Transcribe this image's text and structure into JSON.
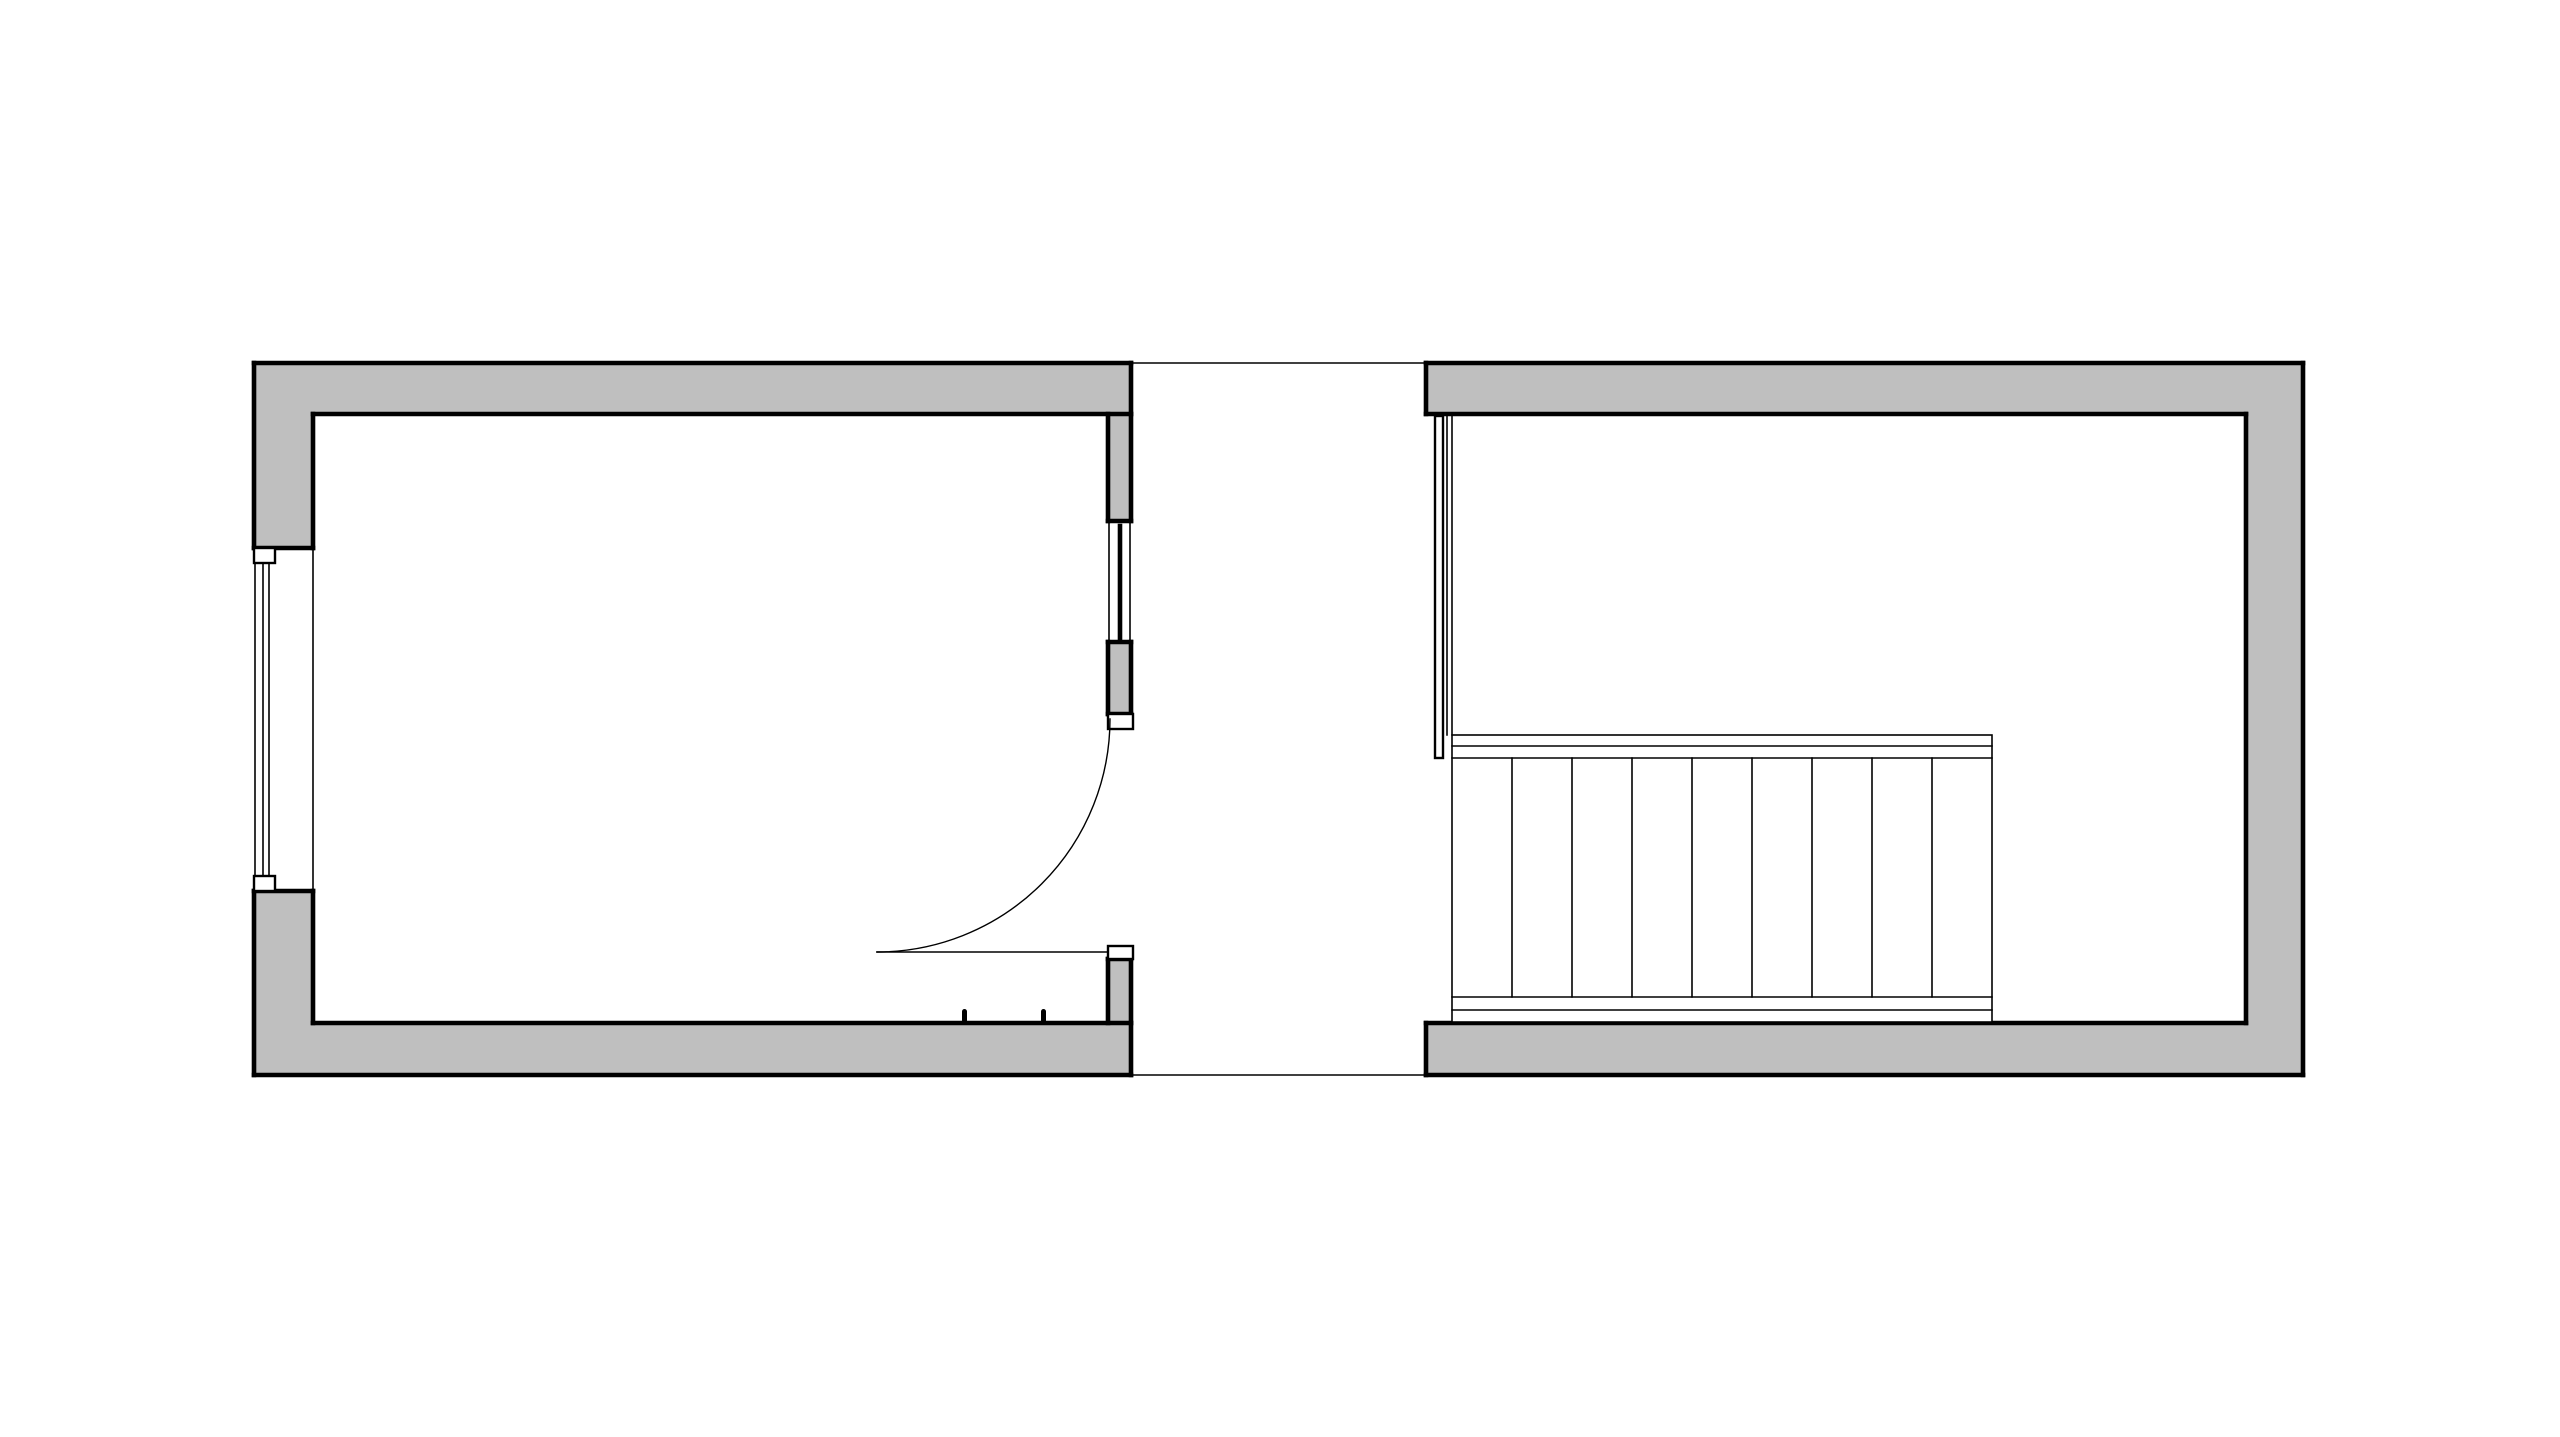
{
  "canvas": {
    "width": 2560,
    "height": 1437,
    "background": "#ffffff"
  },
  "palette": {
    "wall_fill": "#bfbfbf",
    "outline": "#000000",
    "white": "#ffffff",
    "none": "none"
  },
  "stroke_widths": {
    "thick": 4.6,
    "medium": 2.4,
    "thin": 1.6,
    "hairline": 1.4
  },
  "plan": {
    "description_elements": {
      "left_room": "room with exterior window, door to corridor, sidelight window",
      "corridor": "open gap between rooms bounded by thin floor lines",
      "right_room": "room containing straight staircase with railing"
    }
  },
  "shapes": [
    {
      "name": "left-room-top-wall-fill",
      "kind": "rect",
      "x": 254,
      "y": 363,
      "w": 877,
      "h": 51,
      "fill": "wall_fill"
    },
    {
      "name": "left-room-left-wall-upper-fill",
      "kind": "rect",
      "x": 254,
      "y": 363,
      "w": 59,
      "h": 185,
      "fill": "wall_fill"
    },
    {
      "name": "left-room-left-wall-lower-fill",
      "kind": "rect",
      "x": 254,
      "y": 891,
      "w": 59,
      "h": 184,
      "fill": "wall_fill"
    },
    {
      "name": "left-room-bottom-wall-fill",
      "kind": "rect",
      "x": 254,
      "y": 1023,
      "w": 877,
      "h": 52,
      "fill": "wall_fill"
    },
    {
      "name": "partition-wall-upper-fill",
      "kind": "rect",
      "x": 1108,
      "y": 414,
      "w": 23,
      "h": 107,
      "fill": "wall_fill"
    },
    {
      "name": "partition-wall-middle-fill",
      "kind": "rect",
      "x": 1108,
      "y": 642,
      "w": 23,
      "h": 72,
      "fill": "wall_fill"
    },
    {
      "name": "partition-wall-lower-fill",
      "kind": "rect",
      "x": 1108,
      "y": 959,
      "w": 23,
      "h": 64,
      "fill": "wall_fill"
    },
    {
      "name": "right-room-top-wall-fill",
      "kind": "rect",
      "x": 1426,
      "y": 363,
      "w": 877,
      "h": 51,
      "fill": "wall_fill"
    },
    {
      "name": "right-room-right-wall-fill",
      "kind": "rect",
      "x": 2246,
      "y": 363,
      "w": 57,
      "h": 712,
      "fill": "wall_fill"
    },
    {
      "name": "right-room-bottom-wall-fill",
      "kind": "rect",
      "x": 1426,
      "y": 1023,
      "w": 877,
      "h": 52,
      "fill": "wall_fill"
    },
    {
      "name": "left-room-outer-top-edge",
      "kind": "line",
      "x1": 254,
      "y1": 363,
      "x2": 1131,
      "y2": 363,
      "stroke": "outline",
      "sw": "thick"
    },
    {
      "name": "left-room-outer-left-upper-edge",
      "kind": "line",
      "x1": 254,
      "y1": 363,
      "x2": 254,
      "y2": 548,
      "stroke": "outline",
      "sw": "thick"
    },
    {
      "name": "left-room-outer-left-lower-edge",
      "kind": "line",
      "x1": 254,
      "y1": 891,
      "x2": 254,
      "y2": 1075,
      "stroke": "outline",
      "sw": "thick"
    },
    {
      "name": "left-room-outer-bottom-edge",
      "kind": "line",
      "x1": 254,
      "y1": 1075,
      "x2": 1131,
      "y2": 1075,
      "stroke": "outline",
      "sw": "thick"
    },
    {
      "name": "left-room-top-wall-right-edge",
      "kind": "line",
      "x1": 1131,
      "y1": 363,
      "x2": 1131,
      "y2": 414,
      "stroke": "outline",
      "sw": "thick"
    },
    {
      "name": "left-room-bottom-wall-right-edge",
      "kind": "line",
      "x1": 1131,
      "y1": 1023,
      "x2": 1131,
      "y2": 1075,
      "stroke": "outline",
      "sw": "thick"
    },
    {
      "name": "left-room-inner-top-edge",
      "kind": "line",
      "x1": 313,
      "y1": 414,
      "x2": 1131,
      "y2": 414,
      "stroke": "outline",
      "sw": "thick"
    },
    {
      "name": "left-room-inner-left-upper-edge",
      "kind": "line",
      "x1": 313,
      "y1": 414,
      "x2": 313,
      "y2": 548,
      "stroke": "outline",
      "sw": "thick"
    },
    {
      "name": "left-room-inner-left-lower-edge",
      "kind": "line",
      "x1": 313,
      "y1": 891,
      "x2": 313,
      "y2": 1023,
      "stroke": "outline",
      "sw": "thick"
    },
    {
      "name": "left-room-inner-bottom-edge",
      "kind": "line",
      "x1": 313,
      "y1": 1023,
      "x2": 1131,
      "y2": 1023,
      "stroke": "outline",
      "sw": "thick"
    },
    {
      "name": "window-opening-top-edge",
      "kind": "line",
      "x1": 254,
      "y1": 548,
      "x2": 313,
      "y2": 548,
      "stroke": "outline",
      "sw": "thick"
    },
    {
      "name": "window-opening-bottom-edge",
      "kind": "line",
      "x1": 254,
      "y1": 891,
      "x2": 313,
      "y2": 891,
      "stroke": "outline",
      "sw": "thick"
    },
    {
      "name": "partition-upper-left-edge",
      "kind": "line",
      "x1": 1108,
      "y1": 414,
      "x2": 1108,
      "y2": 521,
      "stroke": "outline",
      "sw": "thick"
    },
    {
      "name": "partition-upper-right-edge",
      "kind": "line",
      "x1": 1131,
      "y1": 414,
      "x2": 1131,
      "y2": 521,
      "stroke": "outline",
      "sw": "thick"
    },
    {
      "name": "partition-upper-bottom-edge",
      "kind": "line",
      "x1": 1108,
      "y1": 521,
      "x2": 1131,
      "y2": 521,
      "stroke": "outline",
      "sw": "thick"
    },
    {
      "name": "partition-middle-top-edge",
      "kind": "line",
      "x1": 1108,
      "y1": 642,
      "x2": 1131,
      "y2": 642,
      "stroke": "outline",
      "sw": "thick"
    },
    {
      "name": "partition-middle-left-edge",
      "kind": "line",
      "x1": 1108,
      "y1": 642,
      "x2": 1108,
      "y2": 714,
      "stroke": "outline",
      "sw": "thick"
    },
    {
      "name": "partition-middle-right-edge",
      "kind": "line",
      "x1": 1131,
      "y1": 642,
      "x2": 1131,
      "y2": 714,
      "stroke": "outline",
      "sw": "thick"
    },
    {
      "name": "partition-middle-bottom-edge",
      "kind": "line",
      "x1": 1108,
      "y1": 714,
      "x2": 1131,
      "y2": 714,
      "stroke": "outline",
      "sw": "thick"
    },
    {
      "name": "partition-lower-top-edge",
      "kind": "line",
      "x1": 1108,
      "y1": 959,
      "x2": 1131,
      "y2": 959,
      "stroke": "outline",
      "sw": "thick"
    },
    {
      "name": "partition-lower-left-edge",
      "kind": "line",
      "x1": 1108,
      "y1": 959,
      "x2": 1108,
      "y2": 1023,
      "stroke": "outline",
      "sw": "thick"
    },
    {
      "name": "partition-lower-right-edge",
      "kind": "line",
      "x1": 1131,
      "y1": 959,
      "x2": 1131,
      "y2": 1023,
      "stroke": "outline",
      "sw": "thick"
    },
    {
      "name": "right-room-outer-top-edge",
      "kind": "line",
      "x1": 1426,
      "y1": 363,
      "x2": 2303,
      "y2": 363,
      "stroke": "outline",
      "sw": "thick"
    },
    {
      "name": "right-room-outer-right-edge",
      "kind": "line",
      "x1": 2303,
      "y1": 363,
      "x2": 2303,
      "y2": 1075,
      "stroke": "outline",
      "sw": "thick"
    },
    {
      "name": "right-room-outer-bottom-edge",
      "kind": "line",
      "x1": 1426,
      "y1": 1075,
      "x2": 2303,
      "y2": 1075,
      "stroke": "outline",
      "sw": "thick"
    },
    {
      "name": "right-room-top-wall-left-edge",
      "kind": "line",
      "x1": 1426,
      "y1": 363,
      "x2": 1426,
      "y2": 414,
      "stroke": "outline",
      "sw": "thick"
    },
    {
      "name": "right-room-bottom-wall-left-edge",
      "kind": "line",
      "x1": 1426,
      "y1": 1023,
      "x2": 1426,
      "y2": 1075,
      "stroke": "outline",
      "sw": "thick"
    },
    {
      "name": "right-room-inner-top-edge",
      "kind": "line",
      "x1": 1426,
      "y1": 414,
      "x2": 2246,
      "y2": 414,
      "stroke": "outline",
      "sw": "thick"
    },
    {
      "name": "right-room-inner-right-edge",
      "kind": "line",
      "x1": 2246,
      "y1": 414,
      "x2": 2246,
      "y2": 1023,
      "stroke": "outline",
      "sw": "thick"
    },
    {
      "name": "right-room-inner-bottom-edge",
      "kind": "line",
      "x1": 1426,
      "y1": 1023,
      "x2": 2246,
      "y2": 1023,
      "stroke": "outline",
      "sw": "thick"
    },
    {
      "name": "corridor-top-line",
      "kind": "line",
      "x1": 1131,
      "y1": 363,
      "x2": 1426,
      "y2": 363,
      "stroke": "outline",
      "sw": "thin"
    },
    {
      "name": "corridor-bottom-line",
      "kind": "line",
      "x1": 1131,
      "y1": 1075,
      "x2": 1426,
      "y2": 1075,
      "stroke": "outline",
      "sw": "thin"
    },
    {
      "name": "window-outer-face-line",
      "kind": "line",
      "x1": 255,
      "y1": 563,
      "x2": 255,
      "y2": 876,
      "stroke": "outline",
      "sw": "thin"
    },
    {
      "name": "window-glazing-line-a",
      "kind": "line",
      "x1": 263,
      "y1": 563,
      "x2": 263,
      "y2": 876,
      "stroke": "outline",
      "sw": "thin"
    },
    {
      "name": "window-glazing-line-b",
      "kind": "line",
      "x1": 269,
      "y1": 563,
      "x2": 269,
      "y2": 876,
      "stroke": "outline",
      "sw": "thin"
    },
    {
      "name": "window-inner-reveal-line",
      "kind": "line",
      "x1": 313,
      "y1": 548,
      "x2": 313,
      "y2": 891,
      "stroke": "outline",
      "sw": "thin"
    },
    {
      "name": "window-frame-top-box",
      "kind": "rect",
      "x": 254,
      "y": 548,
      "w": 21,
      "h": 15,
      "fill": "white",
      "stroke": "outline",
      "sw": "medium"
    },
    {
      "name": "window-frame-bottom-box",
      "kind": "rect",
      "x": 254,
      "y": 876,
      "w": 21,
      "h": 15,
      "fill": "white",
      "stroke": "outline",
      "sw": "medium"
    },
    {
      "name": "sidelight-side-line-a",
      "kind": "line",
      "x1": 1109,
      "y1": 521,
      "x2": 1109,
      "y2": 642,
      "stroke": "outline",
      "sw": "thin"
    },
    {
      "name": "sidelight-side-line-b",
      "kind": "line",
      "x1": 1130,
      "y1": 521,
      "x2": 1130,
      "y2": 642,
      "stroke": "outline",
      "sw": "thin"
    },
    {
      "name": "sidelight-glazing-bar",
      "kind": "line",
      "x1": 1120,
      "y1": 526,
      "x2": 1120,
      "y2": 638,
      "stroke": "outline",
      "sw": "thick"
    },
    {
      "name": "door-jamb-top-box",
      "kind": "rect",
      "x": 1108,
      "y": 714,
      "w": 25,
      "h": 15,
      "fill": "white",
      "stroke": "outline",
      "sw": "medium"
    },
    {
      "name": "door-jamb-bottom-box",
      "kind": "rect",
      "x": 1108,
      "y": 946,
      "w": 25,
      "h": 13,
      "fill": "white",
      "stroke": "outline",
      "sw": "medium"
    },
    {
      "name": "door-swing-arc",
      "kind": "path",
      "d": "M 877 952 A 233 233 0 0 0 1110 719",
      "fill": "none",
      "stroke": "outline",
      "sw": "hairline"
    },
    {
      "name": "door-leaf-line",
      "kind": "line",
      "x1": 877,
      "y1": 952,
      "x2": 1108,
      "y2": 952,
      "stroke": "outline",
      "sw": "thin"
    },
    {
      "name": "door-stop-tick-a",
      "kind": "rect",
      "x": 962,
      "y": 1009,
      "w": 5,
      "h": 14,
      "rx": 2.5,
      "fill": "outline"
    },
    {
      "name": "door-stop-tick-b",
      "kind": "rect",
      "x": 1041,
      "y": 1009,
      "w": 5,
      "h": 14,
      "rx": 2.5,
      "fill": "outline"
    },
    {
      "name": "stairwell-edge-line-a",
      "kind": "line",
      "x1": 1447,
      "y1": 414,
      "x2": 1447,
      "y2": 735,
      "stroke": "outline",
      "sw": "thin"
    },
    {
      "name": "stairwell-edge-line-b",
      "kind": "line",
      "x1": 1452,
      "y1": 414,
      "x2": 1452,
      "y2": 735,
      "stroke": "outline",
      "sw": "thin"
    },
    {
      "name": "stair-railing",
      "kind": "rect",
      "x": 1435,
      "y": 416,
      "w": 8,
      "h": 342,
      "fill": "white",
      "stroke": "outline",
      "sw": "medium"
    },
    {
      "name": "stair-block-outline",
      "kind": "rect",
      "x": 1452,
      "y": 735,
      "w": 540,
      "h": 287,
      "fill": "white",
      "stroke": "outline",
      "sw": "thin"
    },
    {
      "name": "stair-top-nosing-line-a",
      "kind": "line",
      "x1": 1452,
      "y1": 746,
      "x2": 1992,
      "y2": 746,
      "stroke": "outline",
      "sw": "thin"
    },
    {
      "name": "stair-top-nosing-line-b",
      "kind": "line",
      "x1": 1452,
      "y1": 758,
      "x2": 1992,
      "y2": 758,
      "stroke": "outline",
      "sw": "thin"
    },
    {
      "name": "stair-bottom-nosing-line-a",
      "kind": "line",
      "x1": 1452,
      "y1": 997,
      "x2": 1992,
      "y2": 997,
      "stroke": "outline",
      "sw": "thin"
    },
    {
      "name": "stair-bottom-nosing-line-b",
      "kind": "line",
      "x1": 1452,
      "y1": 1010,
      "x2": 1992,
      "y2": 1010,
      "stroke": "outline",
      "sw": "thin"
    },
    {
      "name": "stair-tread-line-1",
      "kind": "line",
      "x1": 1512,
      "y1": 758,
      "x2": 1512,
      "y2": 997,
      "stroke": "outline",
      "sw": "thin"
    },
    {
      "name": "stair-tread-line-2",
      "kind": "line",
      "x1": 1572,
      "y1": 758,
      "x2": 1572,
      "y2": 997,
      "stroke": "outline",
      "sw": "thin"
    },
    {
      "name": "stair-tread-line-3",
      "kind": "line",
      "x1": 1632,
      "y1": 758,
      "x2": 1632,
      "y2": 997,
      "stroke": "outline",
      "sw": "thin"
    },
    {
      "name": "stair-tread-line-4",
      "kind": "line",
      "x1": 1692,
      "y1": 758,
      "x2": 1692,
      "y2": 997,
      "stroke": "outline",
      "sw": "thin"
    },
    {
      "name": "stair-tread-line-5",
      "kind": "line",
      "x1": 1752,
      "y1": 758,
      "x2": 1752,
      "y2": 997,
      "stroke": "outline",
      "sw": "thin"
    },
    {
      "name": "stair-tread-line-6",
      "kind": "line",
      "x1": 1812,
      "y1": 758,
      "x2": 1812,
      "y2": 997,
      "stroke": "outline",
      "sw": "thin"
    },
    {
      "name": "stair-tread-line-7",
      "kind": "line",
      "x1": 1872,
      "y1": 758,
      "x2": 1872,
      "y2": 997,
      "stroke": "outline",
      "sw": "thin"
    },
    {
      "name": "stair-tread-line-8",
      "kind": "line",
      "x1": 1932,
      "y1": 758,
      "x2": 1932,
      "y2": 997,
      "stroke": "outline",
      "sw": "thin"
    }
  ]
}
